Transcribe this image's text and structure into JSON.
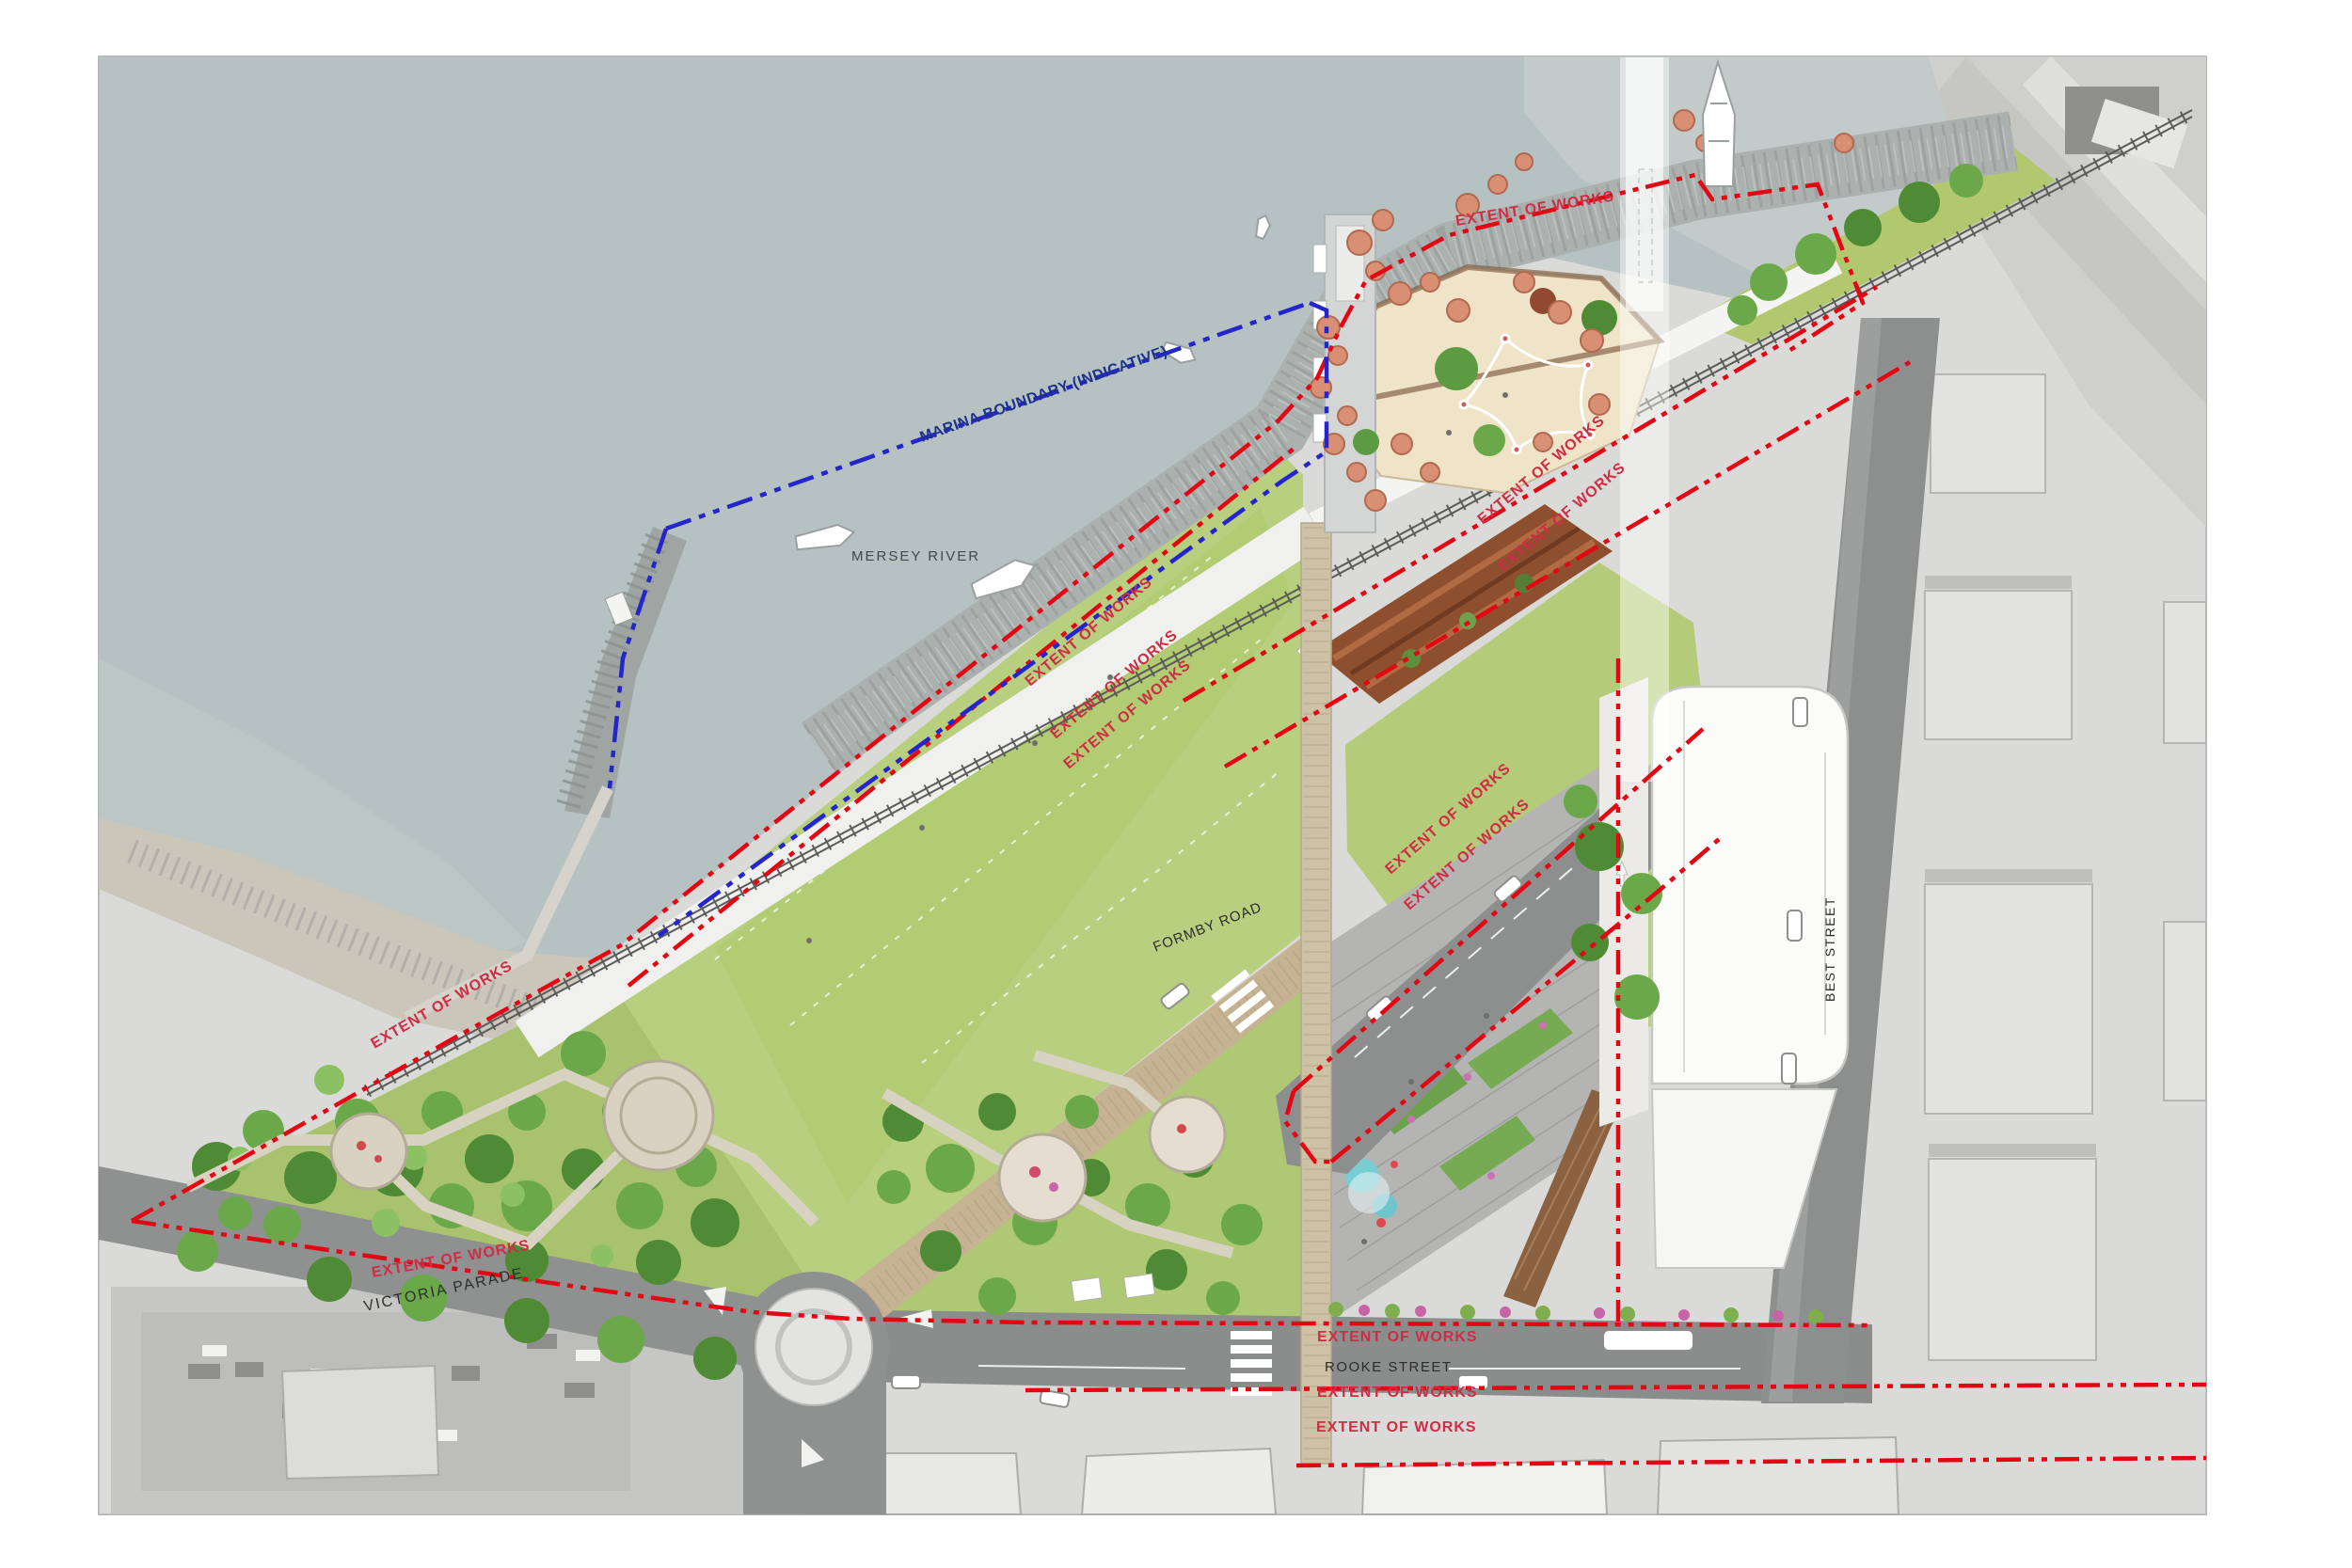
{
  "plan": {
    "labels": {
      "extent_of_works": "EXTENT OF WORKS",
      "marina_boundary": "MARINA BOUNDARY (INDICATIVE)",
      "mersey_river": "MERSEY RIVER"
    },
    "streets": {
      "victoria_parade": "VICTORIA PARADE",
      "rooke_street": "ROOKE STREET",
      "formby_road": "FORMBY ROAD",
      "best_street": "BEST STREET"
    },
    "colors": {
      "extent_red": "#e30613",
      "label_red": "#cf2d45",
      "marina_blue": "#2525cc",
      "navy_text": "#1f3289",
      "street_text": "#2d2d2d",
      "river_text": "#3a4a52"
    }
  }
}
